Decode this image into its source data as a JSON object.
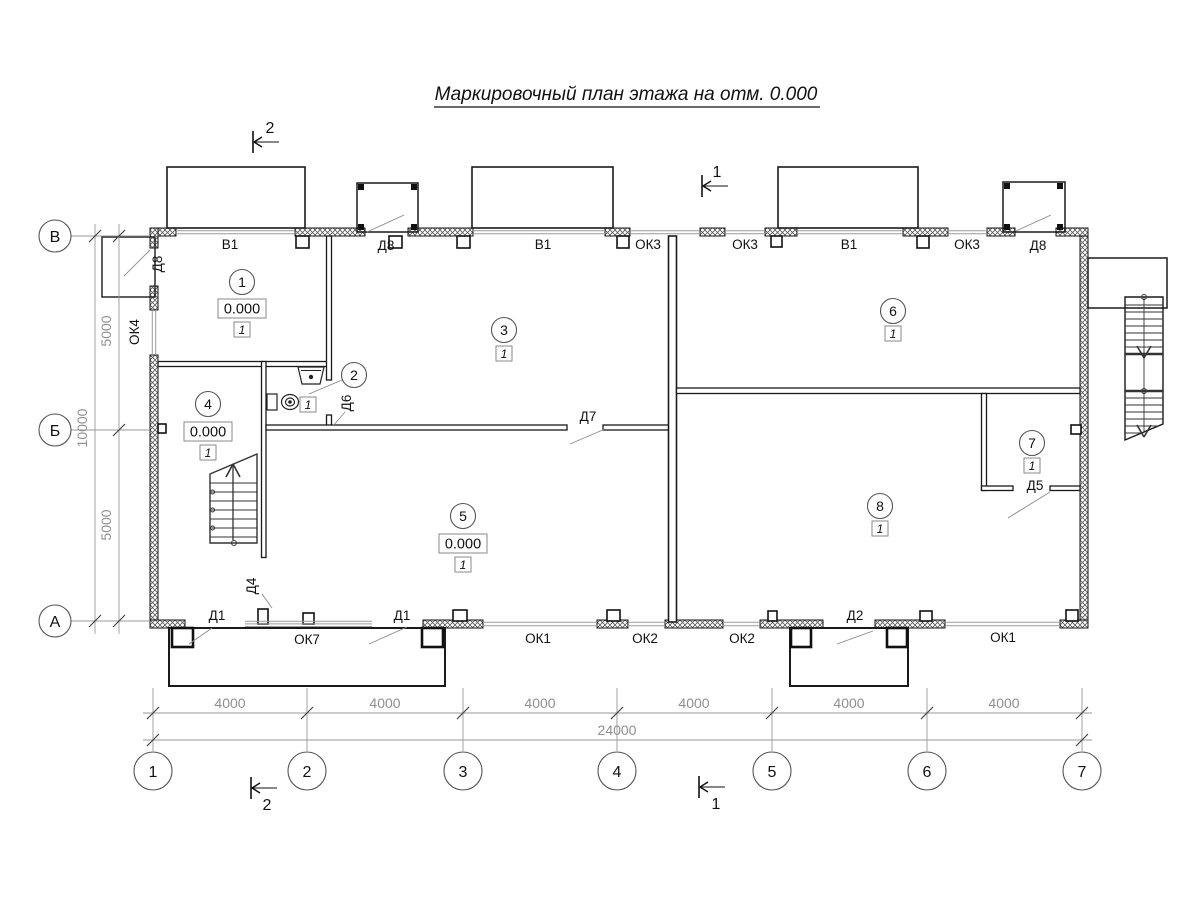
{
  "title": "Маркировочный план этажа на отм. 0.000",
  "axes": {
    "vertical": [
      {
        "label": "В"
      },
      {
        "label": "Б"
      },
      {
        "label": "А"
      }
    ],
    "horizontal": [
      {
        "label": "1"
      },
      {
        "label": "2"
      },
      {
        "label": "3"
      },
      {
        "label": "4"
      },
      {
        "label": "5"
      },
      {
        "label": "6"
      },
      {
        "label": "7"
      }
    ]
  },
  "dimensions": {
    "left": {
      "segments": [
        "5000",
        "5000"
      ],
      "total": "10000"
    },
    "bottom": {
      "segments": [
        "4000",
        "4000",
        "4000",
        "4000",
        "4000",
        "4000"
      ],
      "total": "24000"
    }
  },
  "section_marks": {
    "top_left": "2",
    "top_right": "1",
    "bottom_left": "2",
    "bottom_right": "1"
  },
  "rooms": {
    "r1": {
      "number": "1",
      "elevation": "0.000",
      "finish_type": "1"
    },
    "r2": {
      "number": "2",
      "finish_type": "1"
    },
    "r3": {
      "number": "3",
      "finish_type": "1"
    },
    "r4": {
      "number": "4",
      "elevation": "0.000",
      "finish_type": "1"
    },
    "r5": {
      "number": "5",
      "elevation": "0.000",
      "finish_type": "1"
    },
    "r6": {
      "number": "6",
      "finish_type": "1"
    },
    "r7": {
      "number": "7",
      "finish_type": "1"
    },
    "r8": {
      "number": "8",
      "finish_type": "1"
    }
  },
  "openings": {
    "top": [
      "В1",
      "Д8",
      "В1",
      "ОК3",
      "ОК3",
      "В1",
      "ОК3",
      "Д8"
    ],
    "left_wall": {
      "door": "Д8",
      "window": "ОК4"
    },
    "bottom": {
      "d1a": "Д1",
      "d4": "Д4",
      "ok7": "ОК7",
      "d1b": "Д1",
      "ok1a": "ОК1",
      "ok2a": "ОК2",
      "ok2b": "ОК2",
      "d2": "Д2",
      "ok1b": "ОК1"
    },
    "interior": {
      "d6": "Д6",
      "d7": "Д7",
      "d5": "Д5"
    }
  }
}
